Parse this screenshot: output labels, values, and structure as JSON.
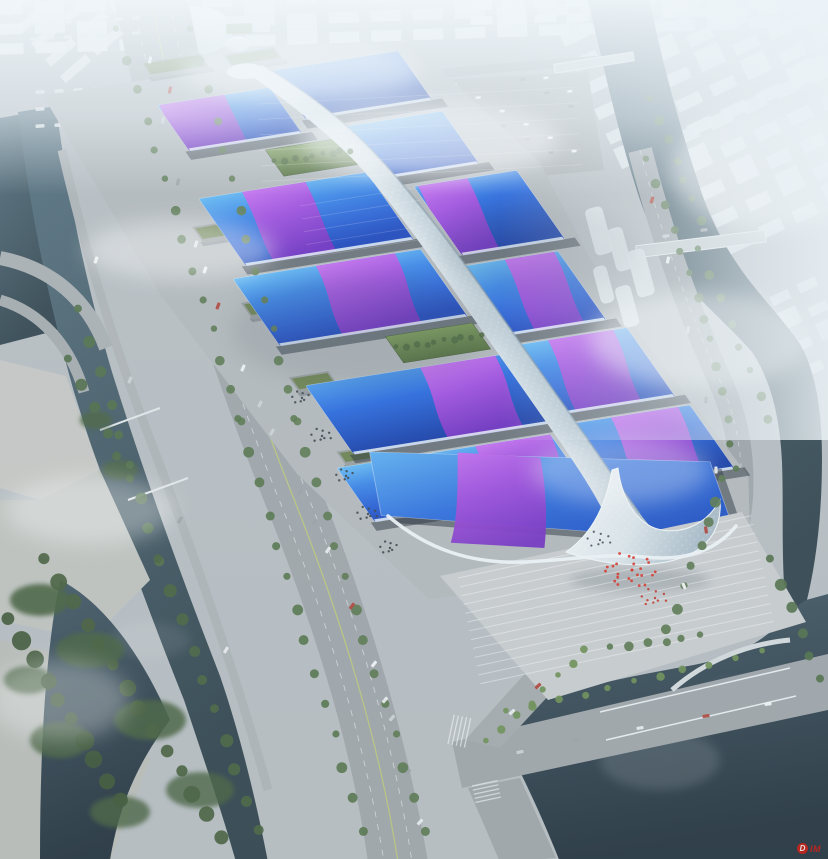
{
  "meta": {
    "alt": "Aerial rendering of a large riverside exhibition and convention center complex with rows of blue wave-form roofs crossed by purple ribbons, a central white spine walkway, surrounding roads, canals, parks and a hazy white city skyline",
    "type": "architectural-rendering"
  },
  "watermark": {
    "badge": "D",
    "text": "IM",
    "color": "#cf2318"
  },
  "palette": {
    "roof_blue_bright": "#55a8f0",
    "roof_blue_deep": "#1d47bc",
    "ribbon_magenta": "#cf72f2",
    "ribbon_purple": "#7231c2",
    "spine_white": "#eef4f8",
    "water_teal": "#4a6672",
    "water_dark": "#263540",
    "road_gray": "#9fa6aa",
    "plaza_gray": "#c9cdcf",
    "tree_green": "#5a7850",
    "haze_white": "#f2f6f8"
  },
  "scene": {
    "halls": [
      [
        48,
        -70,
        114,
        56,
        "gRoofA",
        [
          2,
          66,
          -10
        ]
      ],
      [
        174,
        -88,
        128,
        60,
        "gRoofB",
        null
      ],
      [
        204,
        -14,
        100,
        64,
        "gRoofA",
        null
      ],
      [
        26,
        40,
        170,
        82,
        "gRoofA",
        [
          44,
          64,
          -16
        ]
      ],
      [
        230,
        64,
        104,
        84,
        "gRoofB",
        [
          4,
          50,
          -16
        ]
      ],
      [
        6,
        134,
        190,
        82,
        "gRoofA",
        [
          84,
          80,
          -20
        ]
      ],
      [
        226,
        160,
        94,
        84,
        "gRoofA",
        [
          40,
          50,
          -18
        ]
      ],
      [
        4,
        264,
        200,
        84,
        "gRoofB",
        [
          116,
          76,
          -20
        ]
      ],
      [
        224,
        256,
        110,
        84,
        "gRoofA",
        [
          30,
          66,
          -20
        ]
      ],
      [
        -20,
        360,
        216,
        66,
        "gRoofA",
        [
          140,
          76,
          -18
        ]
      ],
      [
        226,
        352,
        116,
        78,
        "gRoofB",
        [
          36,
          68,
          -18
        ]
      ]
    ],
    "greens": [
      [
        118,
        -2,
        78,
        32
      ],
      [
        108,
        224,
        88,
        32
      ]
    ],
    "buildings": [
      [
        2,
        70,
        38,
        20
      ],
      [
        -2,
        162,
        40,
        20
      ],
      [
        -6,
        252,
        40,
        20
      ],
      [
        -10,
        342,
        36,
        18
      ],
      [
        60,
        -120,
        60,
        20
      ],
      [
        140,
        -114,
        52,
        18
      ]
    ],
    "treeLines": [
      [
        118,
        30,
        240,
        420,
        14,
        4,
        "#5a7850"
      ],
      [
        240,
        420,
        362,
        830,
        14,
        4.5,
        "#55754c"
      ],
      [
        192,
        30,
        296,
        420,
        14,
        4,
        "#5f7d52"
      ],
      [
        296,
        420,
        424,
        830,
        14,
        4.5,
        "#5a7850"
      ],
      [
        80,
        310,
        160,
        560,
        9,
        5,
        "#50704a"
      ],
      [
        160,
        560,
        258,
        830,
        10,
        5.5,
        "#486440"
      ],
      [
        648,
        160,
        706,
        320,
        8,
        4,
        "#5a7850"
      ],
      [
        712,
        340,
        736,
        470,
        6,
        4,
        "#55754c"
      ],
      [
        724,
        480,
        668,
        630,
        8,
        4.5,
        "#5a7850"
      ],
      [
        652,
        100,
        700,
        220,
        7,
        4,
        "#587850"
      ],
      [
        700,
        250,
        770,
        420,
        8,
        4,
        "#5a7a50"
      ],
      [
        276,
        162,
        351,
        150,
        9,
        3,
        "#4e6b3e"
      ],
      [
        398,
        348,
        481,
        335,
        10,
        3,
        "#4e6b3e"
      ],
      [
        508,
        712,
        760,
        652,
        11,
        3.5,
        "#6d8f55"
      ],
      [
        488,
        742,
        586,
        650,
        8,
        3.5,
        "#6d8f55"
      ],
      [
        46,
        560,
        220,
        836,
        14,
        7,
        "#46603e"
      ],
      [
        10,
        620,
        120,
        800,
        10,
        8,
        "#3f5838"
      ],
      [
        70,
        360,
        130,
        480,
        6,
        5,
        "#4e6b46"
      ],
      [
        612,
        648,
        700,
        636,
        6,
        4,
        "#5a7850"
      ],
      [
        772,
        560,
        820,
        680,
        6,
        5,
        "#50704a"
      ]
    ],
    "dotClusters": [
      [
        632,
        570,
        26,
        1.4,
        "#d83428",
        28
      ],
      [
        655,
        598,
        10,
        1.2,
        "#c23428",
        15
      ],
      [
        302,
        398,
        8,
        1.2,
        "#39424a",
        11
      ],
      [
        322,
        436,
        9,
        1.2,
        "#39424a",
        12
      ],
      [
        346,
        476,
        8,
        1.2,
        "#39424a",
        11
      ],
      [
        368,
        514,
        9,
        1.2,
        "#39424a",
        12
      ],
      [
        390,
        548,
        8,
        1.2,
        "#39424a",
        11
      ],
      [
        600,
        540,
        9,
        1.1,
        "#434c52",
        14
      ]
    ],
    "cars": [
      [
        150,
        60,
        -79
      ],
      [
        163,
        120,
        -77
      ],
      [
        178,
        182,
        -75
      ],
      [
        196,
        244,
        -72
      ],
      [
        218,
        306,
        -69
      ],
      [
        243,
        368,
        -66
      ],
      [
        272,
        432,
        -62
      ],
      [
        300,
        492,
        -59
      ],
      [
        328,
        550,
        -56
      ],
      [
        352,
        606,
        -53
      ],
      [
        374,
        664,
        -51
      ],
      [
        392,
        718,
        -49
      ],
      [
        408,
        772,
        -48
      ],
      [
        420,
        822,
        -47
      ],
      [
        170,
        90,
        -78
      ],
      [
        205,
        270,
        -71
      ],
      [
        260,
        404,
        -64
      ],
      [
        315,
        522,
        -57
      ],
      [
        385,
        700,
        -50
      ],
      [
        652,
        200,
        -73
      ],
      [
        668,
        260,
        -77
      ],
      [
        688,
        330,
        -81
      ],
      [
        706,
        400,
        -85
      ],
      [
        716,
        470,
        -91
      ],
      [
        706,
        530,
        -99
      ],
      [
        684,
        586,
        -112
      ],
      [
        520,
        752,
        -12
      ],
      [
        576,
        740,
        -11
      ],
      [
        640,
        728,
        -10
      ],
      [
        706,
        716,
        -9
      ],
      [
        768,
        704,
        -8
      ],
      [
        666,
        236,
        -7
      ],
      [
        704,
        230,
        -7
      ],
      [
        512,
        712,
        -43
      ],
      [
        538,
        686,
        -43
      ],
      [
        96,
        260,
        -70
      ],
      [
        130,
        380,
        -67
      ],
      [
        180,
        520,
        -62
      ],
      [
        226,
        650,
        -58
      ]
    ],
    "carColors": [
      "#f4f6f7",
      "#cdd3d6",
      "#9aa2a7",
      "#e9ecee",
      "#b0453a"
    ],
    "busLots": [
      {
        "x": 242,
        "y": 316,
        "r": 2,
        "c": 4,
        "rdx": 15.8,
        "rdy": -2.5,
        "cdx": 7.5,
        "cdy": 10.6,
        "a": 55,
        "w": 10,
        "h": 3.8,
        "f": "#e6e9ea"
      },
      {
        "x": 282,
        "y": 398,
        "r": 2,
        "c": 5,
        "rdx": 15.8,
        "rdy": -2.5,
        "cdx": 7.5,
        "cdy": 10.6,
        "a": 55,
        "w": 10,
        "h": 3.8,
        "f": "#e2e6e8"
      },
      {
        "x": 326,
        "y": 486,
        "r": 2,
        "c": 4,
        "rdx": 15.8,
        "rdy": -2.5,
        "cdx": 7.5,
        "cdy": 10.6,
        "a": 55,
        "w": 10,
        "h": 3.8,
        "f": "#e6e9ea"
      },
      {
        "x": 40,
        "y": 92,
        "r": 3,
        "c": 6,
        "rdx": 0,
        "rdy": 17,
        "cdx": 19,
        "cdy": -1,
        "a": -4,
        "w": 9,
        "h": 3.4,
        "f": "#dde1e3"
      },
      {
        "x": 34,
        "y": 24,
        "r": 2,
        "c": 7,
        "rdx": 0,
        "rdy": 15,
        "cdx": 17,
        "cdy": -1,
        "a": -3,
        "w": 8,
        "h": 3,
        "f": "#d8dde0"
      }
    ],
    "parkingGrid": {
      "x": 268,
      "y": 96,
      "r": 6,
      "c": 14,
      "dx": 23,
      "dy": 15,
      "a": -4,
      "w": 5,
      "h": 2.6
    },
    "cityGrids": [
      {
        "x": -8,
        "y": 4,
        "r": 3,
        "c": 20,
        "cw": 30,
        "ch": 11,
        "gx": 12,
        "gy": 9,
        "a": -2,
        "f": "#edf2f5",
        "o": 0.85
      },
      {
        "x": 470,
        "y": 2,
        "r": 2,
        "c": 12,
        "cw": 22,
        "ch": 8,
        "gx": 10,
        "gy": 7,
        "a": -2,
        "f": "#f3f7f9",
        "o": 0.9
      },
      {
        "x": 560,
        "y": 36,
        "r": 6,
        "c": 7,
        "cw": 26,
        "ch": 12,
        "gx": 12,
        "gy": 15,
        "a": -25,
        "f": "#e8eff2",
        "o": 0.8
      },
      {
        "x": 640,
        "y": 150,
        "r": 5,
        "c": 6,
        "cw": 24,
        "ch": 13,
        "gx": 13,
        "gy": 17,
        "a": -25,
        "f": "#e2e9ed",
        "o": 0.85
      },
      {
        "x": 2,
        "y": 10,
        "r": 5,
        "c": 3,
        "cw": 34,
        "ch": 9,
        "gx": 8,
        "gy": 13,
        "a": -41,
        "f": "#e7ebed",
        "o": 0.8
      },
      {
        "x": 742,
        "y": 310,
        "r": 4,
        "c": 3,
        "cw": 20,
        "ch": 10,
        "gx": 10,
        "gy": 16,
        "a": -25,
        "f": "#e9eef1",
        "o": 0.7
      }
    ],
    "towers": [
      [
        584,
        210,
        18,
        48,
        -15
      ],
      [
        606,
        230,
        16,
        44,
        -15
      ],
      [
        626,
        252,
        18,
        48,
        -15
      ],
      [
        592,
        268,
        14,
        38,
        -15
      ],
      [
        614,
        288,
        16,
        42,
        -15
      ]
    ],
    "fields": [
      [
        462,
        116,
        32,
        13,
        -3
      ],
      [
        226,
        24,
        26,
        10,
        -2
      ]
    ],
    "parkBlobs": [
      [
        40,
        600,
        30,
        16,
        0.9
      ],
      [
        90,
        650,
        34,
        18,
        0.85
      ],
      [
        150,
        720,
        36,
        20,
        0.85
      ],
      [
        60,
        740,
        30,
        18,
        0.8
      ],
      [
        200,
        790,
        34,
        18,
        0.8
      ],
      [
        120,
        812,
        30,
        16,
        0.8
      ],
      [
        28,
        680,
        24,
        14,
        0.8
      ],
      [
        96,
        420,
        16,
        9,
        0.85
      ],
      [
        120,
        470,
        18,
        10,
        0.85
      ]
    ],
    "fogBlobs": [
      [
        430,
        140,
        130,
        38,
        0.55
      ],
      [
        180,
        250,
        95,
        30,
        0.4
      ],
      [
        700,
        340,
        110,
        48,
        0.45
      ],
      [
        90,
        510,
        85,
        34,
        0.35
      ],
      [
        770,
        170,
        100,
        60,
        0.5
      ],
      [
        300,
        70,
        120,
        30,
        0.5
      ],
      [
        620,
        470,
        90,
        34,
        0.3
      ],
      [
        60,
        700,
        70,
        40,
        0.3
      ]
    ],
    "cloudShadows": [
      [
        360,
        330,
        130,
        55,
        0.1
      ],
      [
        540,
        250,
        100,
        45,
        0.08
      ]
    ],
    "stripes": [
      [
        458,
        578,
        300,
        -12,
        13,
        9,
        "#ffffff",
        0.4,
        1
      ],
      [
        258,
        104,
        320,
        -3,
        6,
        15.5,
        "#ffffff",
        0.22,
        0.8
      ],
      [
        300,
        206,
        120,
        -9,
        5,
        13,
        "#ffffff",
        0.18,
        0.8
      ],
      [
        448,
        744,
        30,
        -78,
        5,
        4.2,
        "#ffffff",
        0.55,
        1.3
      ],
      [
        472,
        786,
        26,
        -12,
        5,
        4.2,
        "#ffffff",
        0.55,
        1.3
      ]
    ],
    "waterGlints": [
      [
        660,
        760,
        60,
        30,
        0.12
      ],
      [
        740,
        700,
        40,
        20,
        0.1
      ],
      [
        150,
        640,
        40,
        18,
        0.08
      ]
    ]
  }
}
